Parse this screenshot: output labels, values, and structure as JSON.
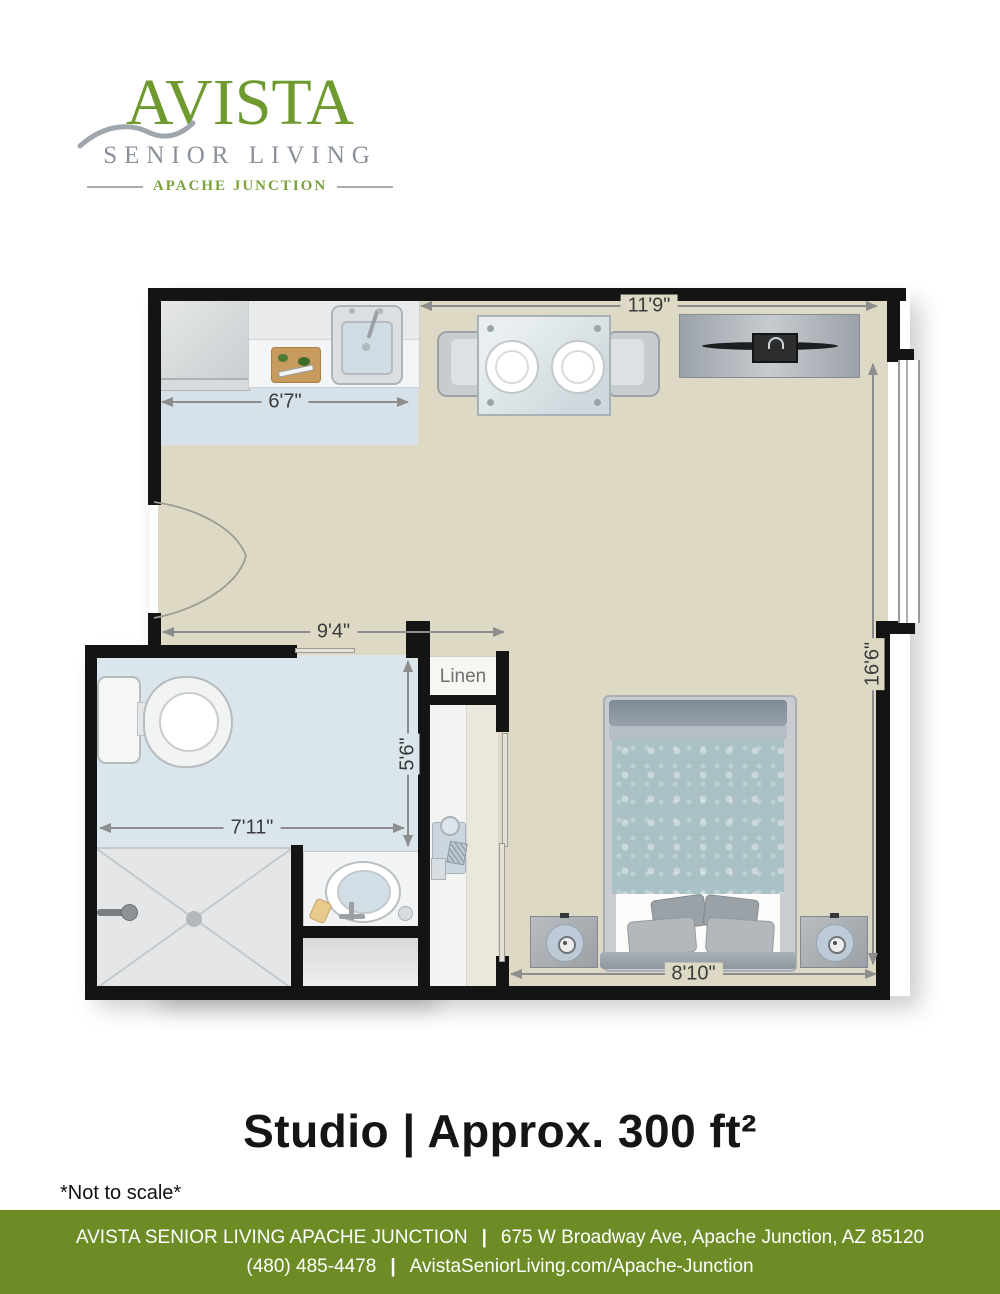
{
  "logo": {
    "brand": "AVISTA",
    "tagline": "SENIOR LIVING",
    "location": "APACHE JUNCTION",
    "brand_color": "#6f9a2f",
    "tagline_color": "#8b919b"
  },
  "floorplan": {
    "room_label_linen": "Linen",
    "dimensions": {
      "living_width": "11'9\"",
      "kitchen_width": "6'7\"",
      "entry_width": "9'4\"",
      "room_height": "16'6\"",
      "bath_width": "7'11\"",
      "bath_height": "5'6\"",
      "bed_wall_width": "8'10\""
    },
    "colors": {
      "wall": "#141414",
      "floor_main": "#ded9c4",
      "floor_kitchen": "#d6e1e9",
      "floor_bath": "#dae5ec",
      "dimension_line": "#8d8d8d"
    }
  },
  "title": {
    "text": "Studio | Approx. 300 ft²"
  },
  "disclaimer": {
    "text": "*Not to scale*"
  },
  "footer": {
    "facility": "AVISTA SENIOR LIVING APACHE JUNCTION",
    "separator": "|",
    "address": "675 W Broadway Ave, Apache Junction, AZ 85120",
    "phone": "(480) 485-4478",
    "website": "AvistaSeniorLiving.com/Apache-Junction",
    "bg_color": "#6d8c26"
  }
}
